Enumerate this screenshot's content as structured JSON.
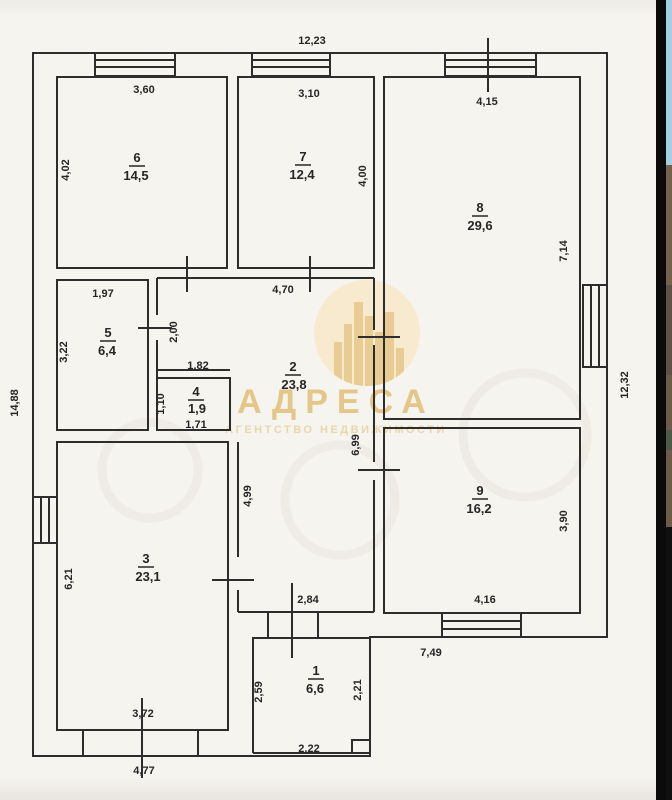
{
  "plan": {
    "exterior": {
      "top": "12,23",
      "left": "14,88",
      "right": "12,32",
      "bottom_left": "4,77",
      "bottom_right": "7,49"
    },
    "rooms": {
      "r1": {
        "number": "1",
        "area": "6,6",
        "dim_left": "2,59",
        "dim_right": "2,21",
        "dim_bottom": "2,22"
      },
      "r2": {
        "number": "2",
        "area": "23,8",
        "dim_top": "4,70",
        "dim_upper_left": "2,00",
        "dim_left": "4,99",
        "dim_right": "6,99",
        "dim_bottom": "2,84"
      },
      "r3": {
        "number": "3",
        "area": "23,1",
        "dim_left": "6,21",
        "dim_bottom": "3,72"
      },
      "r4": {
        "number": "4",
        "area": "1,9",
        "dim_top": "1,82",
        "dim_left": "1,10",
        "dim_bottom": "1,71"
      },
      "r5": {
        "number": "5",
        "area": "6,4",
        "dim_top": "1,97",
        "dim_left": "3,22"
      },
      "r6": {
        "number": "6",
        "area": "14,5",
        "dim_top": "3,60",
        "dim_left": "4,02"
      },
      "r7": {
        "number": "7",
        "area": "12,4",
        "dim_top": "3,10",
        "dim_right": "4,00"
      },
      "r8": {
        "number": "8",
        "area": "29,6",
        "dim_top": "4,15",
        "dim_right": "7,14"
      },
      "r9": {
        "number": "9",
        "area": "16,2",
        "dim_right": "3,90",
        "dim_bottom": "4,16"
      }
    }
  },
  "watermark": {
    "brand": "АДРЕСА",
    "tagline": "АГЕНТСТВО НЕДВИЖИМОСТИ"
  },
  "colors": {
    "accent_gold": "#e2bc73",
    "paper": "#f6f4ef",
    "line": "#2d2d2d"
  }
}
